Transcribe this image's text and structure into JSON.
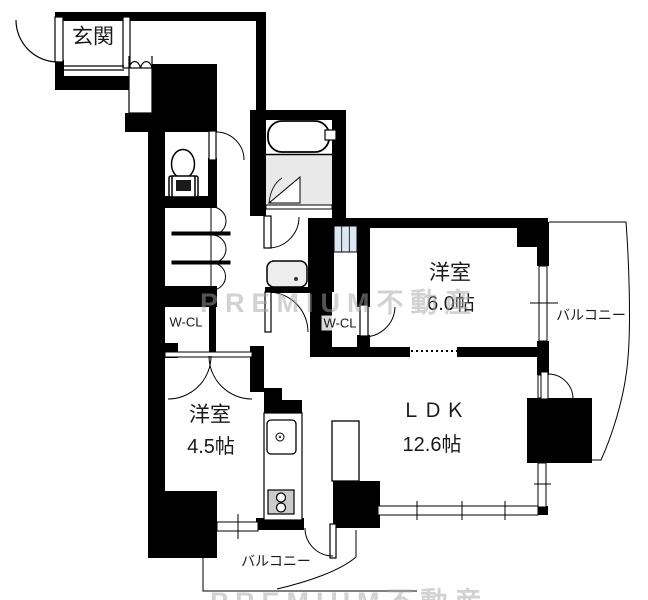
{
  "rooms": {
    "genkan": {
      "label": "玄関"
    },
    "western_6": {
      "label": "洋室",
      "size": "6.0帖"
    },
    "western_45": {
      "label": "洋室",
      "size": "4.5帖"
    },
    "ldk": {
      "label": "ＬＤＫ",
      "size": "12.6帖"
    },
    "wcl_left": {
      "label": "W-CL"
    },
    "wcl_right": {
      "label": "W-CL"
    },
    "balcony_right": {
      "label": "バルコニー"
    },
    "balcony_bottom": {
      "label": "バルコニー"
    }
  },
  "watermark": {
    "text": "PREMIUM不動産"
  },
  "fixtures": [
    "bathtub-icon",
    "toilet-icon",
    "washbasin-icon",
    "washing-machine-space",
    "kitchen-sink-icon",
    "gas-stove-icon",
    "shoe-cabinet",
    "hall-closet-shelves"
  ],
  "colors": {
    "wall": "#000000",
    "bath_floor": "#e9e9e9",
    "washer_panel": "#dce7f3",
    "stove_top": "#cbcbcb",
    "basin": "#ededed",
    "watermark": "#a5a5a5"
  }
}
